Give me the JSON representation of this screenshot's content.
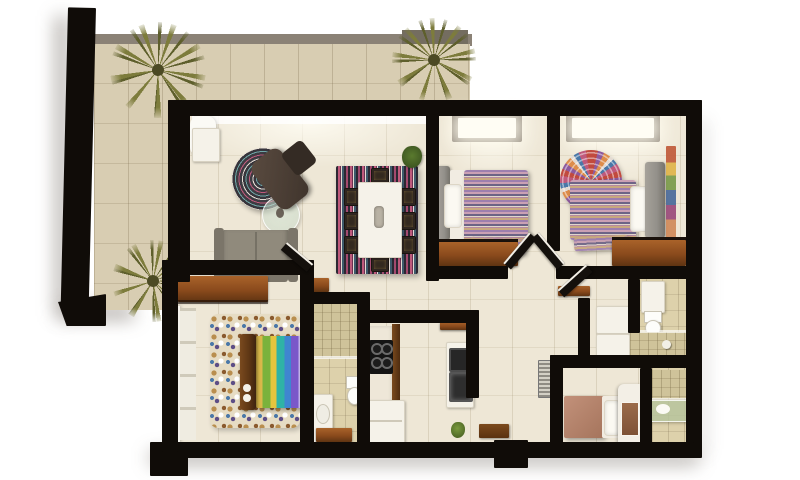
{
  "scene": {
    "type": "architectural-3d-floor-plan",
    "view": "top-down render of a furnished apartment with wraparound terrace",
    "background_color": "#ffffff"
  },
  "colors": {
    "bg": "#ffffff",
    "wall": "#100c08",
    "wall-top": "#8b8276",
    "wall-top-dark": "#746d60",
    "terrace-floor": "#d8cdb2",
    "floor": "#eee7d6",
    "bath-tile": "#ddd1ab",
    "shower-tile": "#cfc39a",
    "wood": "#8a4a1c",
    "wood-dark": "#5f3412",
    "wood-light": "#a9632a",
    "white-furn": "#f5f2e9",
    "sofa": "#908a7c",
    "sofa-dark": "#7b7569",
    "headboard": "#93908a",
    "headboard-wood": "#5c3514",
    "palm": "#7d7c3c",
    "palm-dark": "#5e5f2c",
    "salmon": "#b5846a",
    "doormat": "#6e3d16",
    "plant-green": "#5a7a2e",
    "rug-dark": "#3d3b42",
    "pink": "#bf5a7c",
    "teal": "#6fa8a8",
    "cream": "#e3dad2",
    "purple": "#8d5a9e",
    "orange": "#dd8c4a",
    "red": "#c14a3e",
    "blue": "#4a78a8",
    "rainbow-green": "#7ab23c",
    "rainbow-yellow": "#e6c53d",
    "rainbow-teal": "#2fb3a6",
    "rainbow-blue": "#3f86d0",
    "rainbow-purple": "#7a58c9",
    "rainbow-lavender": "#c0b2e6"
  },
  "rooms": [
    {
      "name": "terrace",
      "furniture": [
        "palm-plant",
        "palm-plant",
        "palm-plant",
        "tiled-floor"
      ]
    },
    {
      "name": "living-room",
      "furniture": [
        "sofa",
        "recliner-chair",
        "round-striped-rug",
        "glass-coffee-table",
        "sheer-curtain",
        "side-cabinet"
      ]
    },
    {
      "name": "dining-area",
      "furniture": [
        "white-dining-table",
        "dining-chairs",
        "striped-rug",
        "potted-plant"
      ]
    },
    {
      "name": "bedroom-1",
      "furniture": [
        "double-bed-striped-blanket",
        "round-mosaic-rug",
        "dresser",
        "skylight"
      ]
    },
    {
      "name": "bedroom-2",
      "furniture": [
        "double-bed-striped-blanket",
        "round-mosaic-rug",
        "wardrobe",
        "skylight",
        "wall-art"
      ]
    },
    {
      "name": "master-bedroom",
      "furniture": [
        "rainbow-striped-bed",
        "pebble-mosaic-rug",
        "wardrobe",
        "window"
      ]
    },
    {
      "name": "kitchen",
      "furniture": [
        "cooktop",
        "counter",
        "fridge",
        "oven",
        "microwave",
        "wall-shelf",
        "small-plant"
      ]
    },
    {
      "name": "ensuite-bathroom",
      "furniture": [
        "shower",
        "toilet",
        "sink-counter",
        "wood-door"
      ]
    },
    {
      "name": "bathroom-2",
      "furniture": [
        "sink-cabinet",
        "toilet",
        "shower"
      ]
    },
    {
      "name": "bathroom-3",
      "furniture": [
        "shower",
        "glass-sink-counter"
      ]
    },
    {
      "name": "utility-closet",
      "furniture": [
        "washer",
        "dryer"
      ]
    },
    {
      "name": "service-bedroom",
      "furniture": [
        "single-bed",
        "corner-closet"
      ]
    },
    {
      "name": "hallway",
      "furniture": [
        "doormat",
        "towel-radiator",
        "wall-shelf",
        "open-doors"
      ]
    }
  ],
  "counts": {
    "bedrooms": 4,
    "bathrooms": 3,
    "palm_plants": 3,
    "dining_chairs": 8
  }
}
